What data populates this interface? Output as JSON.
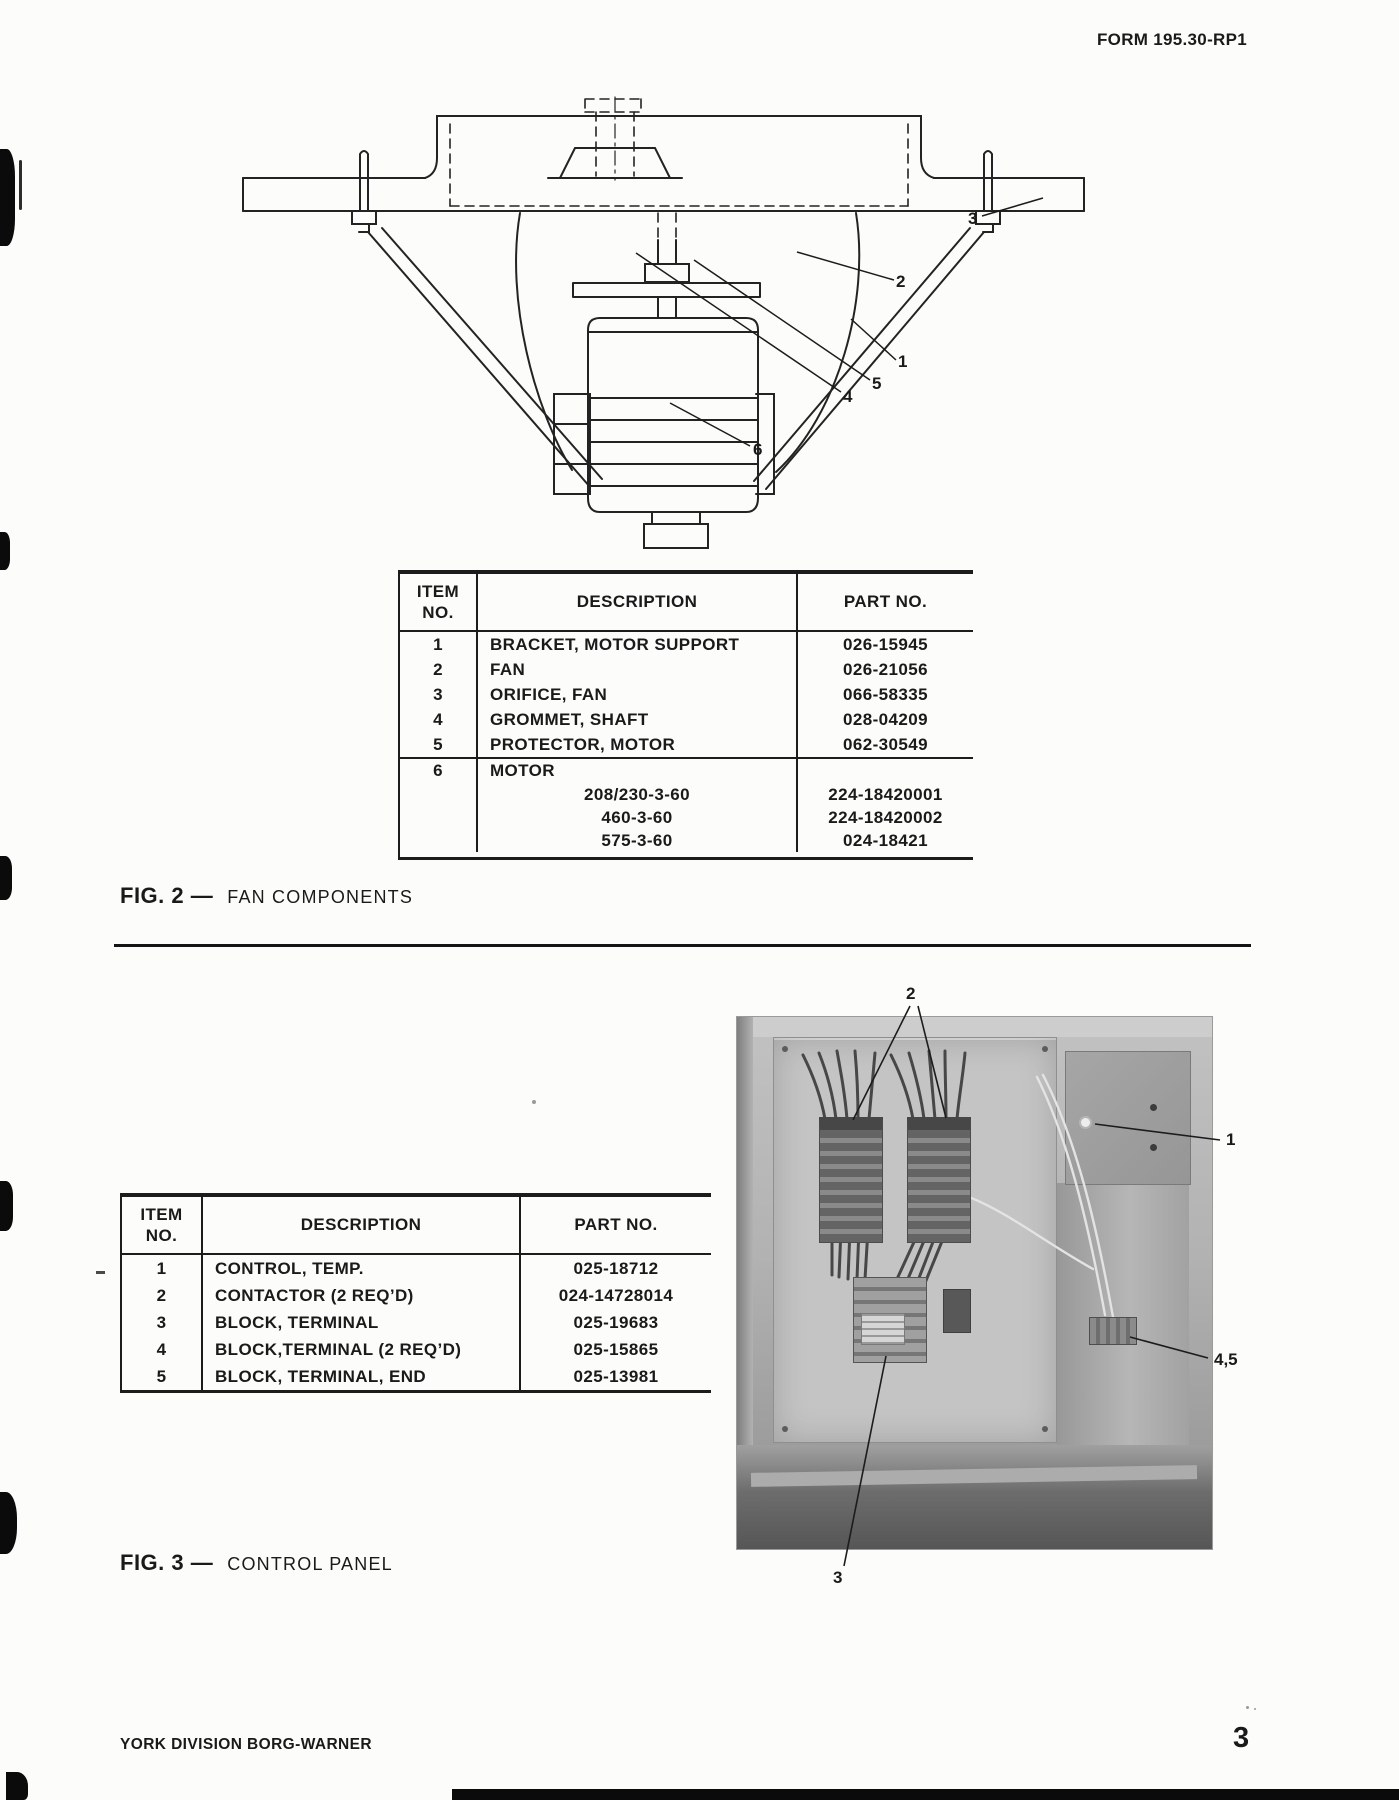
{
  "page": {
    "form_number": "FORM 195.30-RP1",
    "footer": "YORK DIVISION BORG-WARNER",
    "page_number": "3"
  },
  "fig2": {
    "label": "FIG. 2 —",
    "title": "FAN COMPONENTS",
    "callouts": {
      "bracket": "1",
      "fan": "2",
      "orifice": "3",
      "grommet": "4",
      "protector": "5",
      "motor": "6"
    },
    "table": {
      "headers": {
        "item": "ITEM\nNO.",
        "description": "DESCRIPTION",
        "part": "PART NO."
      },
      "rows": [
        {
          "item": "1",
          "description": "BRACKET, MOTOR SUPPORT",
          "part": "026-15945"
        },
        {
          "item": "2",
          "description": "FAN",
          "part": "026-21056"
        },
        {
          "item": "3",
          "description": "ORIFICE, FAN",
          "part": "066-58335"
        },
        {
          "item": "4",
          "description": "GROMMET, SHAFT",
          "part": "028-04209"
        },
        {
          "item": "5",
          "description": "PROTECTOR, MOTOR",
          "part": "062-30549"
        }
      ],
      "motor_group": {
        "item": "6",
        "description": "MOTOR",
        "variants": [
          {
            "description": "208/230-3-60",
            "part": "224-18420001"
          },
          {
            "description": "460-3-60",
            "part": "224-18420002"
          },
          {
            "description": "575-3-60",
            "part": "024-18421"
          }
        ]
      }
    }
  },
  "fig3": {
    "label": "FIG. 3 —",
    "title": "CONTROL PANEL",
    "callouts": {
      "contactors": "2",
      "temp_control": "1",
      "terminal_blocks": "4,5",
      "terminal_block": "3"
    },
    "table": {
      "headers": {
        "item": "ITEM\nNO.",
        "description": "DESCRIPTION",
        "part": "PART NO."
      },
      "rows": [
        {
          "item": "1",
          "description": "CONTROL, TEMP.",
          "part": "025-18712"
        },
        {
          "item": "2",
          "description": "CONTACTOR (2 REQ’D)",
          "part": "024-14728014"
        },
        {
          "item": "3",
          "description": "BLOCK, TERMINAL",
          "part": "025-19683"
        },
        {
          "item": "4",
          "description": "BLOCK,TERMINAL (2 REQ’D)",
          "part": "025-15865"
        },
        {
          "item": "5",
          "description": "BLOCK, TERMINAL, END",
          "part": "025-13981"
        }
      ]
    }
  }
}
